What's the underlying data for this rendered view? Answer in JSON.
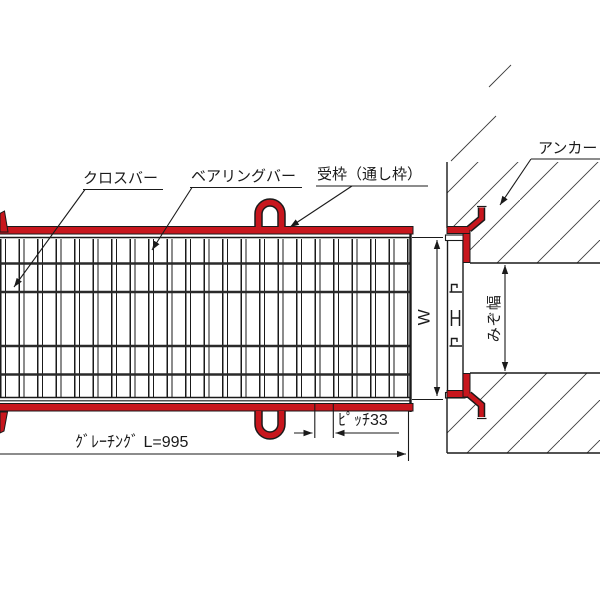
{
  "drawing": {
    "labels": {
      "crossbar": "クロスバー",
      "bearing_bar": "ベアリングバー",
      "frame": "受枠（通し枠）",
      "anchor": "アンカー",
      "grating_width": "W",
      "groove_width": "みぞ幅",
      "pitch": "ﾋﾟｯﾁ33",
      "grating_length": "ｸﾞﾚｰﾁﾝｸﾞ L=995"
    },
    "dimensions": {
      "pitch_mm": 33,
      "grating_length_mm": 995
    },
    "colors": {
      "frame_red": "#c8161d",
      "line_black": "#1a1a1a"
    }
  }
}
